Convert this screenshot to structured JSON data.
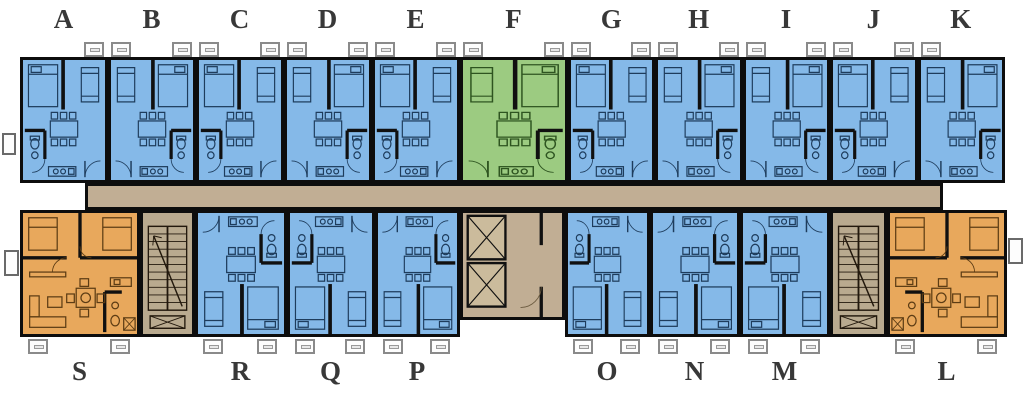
{
  "plan": {
    "type": "residential floor plan",
    "background": "#ffffff"
  },
  "palette": {
    "unit_blue": "#85b9e8",
    "unit_green": "#9ccb81",
    "unit_orange": "#e8a85c",
    "corridor": "#c1ae94",
    "stair": "#b9aa8f",
    "elevator_shaft": "#cbbb9c",
    "wall": "#0d0d0d",
    "label": "#383838"
  },
  "top_row": {
    "units": [
      {
        "label": "A",
        "color": "blue"
      },
      {
        "label": "B",
        "color": "blue"
      },
      {
        "label": "C",
        "color": "blue"
      },
      {
        "label": "D",
        "color": "blue"
      },
      {
        "label": "E",
        "color": "blue"
      },
      {
        "label": "F",
        "color": "green"
      },
      {
        "label": "G",
        "color": "blue"
      },
      {
        "label": "H",
        "color": "blue"
      },
      {
        "label": "I",
        "color": "blue"
      },
      {
        "label": "J",
        "color": "blue"
      },
      {
        "label": "K",
        "color": "blue"
      }
    ]
  },
  "bottom_row": {
    "units": [
      {
        "label": "S",
        "color": "orange",
        "kind": "corner"
      },
      {
        "label": "R",
        "color": "blue",
        "kind": "studio"
      },
      {
        "label": "Q",
        "color": "blue",
        "kind": "studio"
      },
      {
        "label": "P",
        "color": "blue",
        "kind": "studio"
      },
      {
        "label": "O",
        "color": "blue",
        "kind": "studio"
      },
      {
        "label": "N",
        "color": "blue",
        "kind": "studio"
      },
      {
        "label": "M",
        "color": "blue",
        "kind": "studio"
      },
      {
        "label": "L",
        "color": "orange",
        "kind": "corner"
      }
    ]
  },
  "features": {
    "corridor": "central-corridor",
    "elevator_shafts": 2,
    "stairwells": 2
  }
}
